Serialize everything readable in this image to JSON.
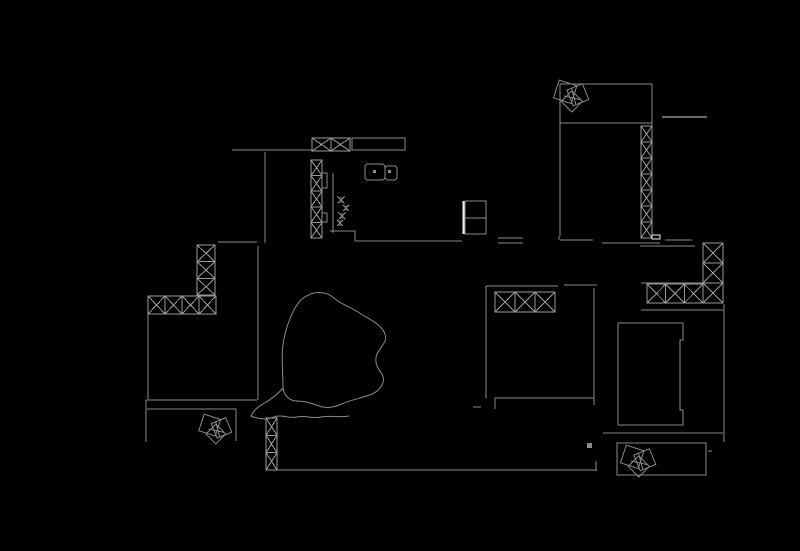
{
  "meta": {
    "app": "cad-floor-plan-view",
    "width": 800,
    "height": 551,
    "background": "#000000"
  },
  "palette": {
    "line": "#8a8a8a",
    "hatch": "#9a9a9a",
    "bright": "#eeeeee",
    "dim": "#6b6b6b",
    "fill": "#8c8c8c"
  },
  "drawing": {
    "walls": [
      {
        "name": "top-room-top-wall",
        "x1": 560,
        "y1": 84,
        "x2": 652,
        "y2": 84
      },
      {
        "name": "top-room-left-wall",
        "x1": 560,
        "y1": 84,
        "x2": 560,
        "y2": 236
      },
      {
        "name": "top-room-divider",
        "x1": 560,
        "y1": 123,
        "x2": 652,
        "y2": 123
      },
      {
        "name": "top-room-right-wall-upper",
        "x1": 652,
        "y1": 84,
        "x2": 652,
        "y2": 126
      },
      {
        "name": "balcony-rail-dash",
        "x1": 662,
        "y1": 117,
        "x2": 707,
        "y2": 117,
        "w": 2,
        "c": "dim"
      },
      {
        "name": "kitchen-top-wall",
        "x1": 232,
        "y1": 150,
        "x2": 312,
        "y2": 150
      },
      {
        "name": "corridor-wall-upper",
        "x1": 265,
        "y1": 152,
        "x2": 265,
        "y2": 243
      },
      {
        "name": "counter-inner-edge",
        "x1": 333,
        "y1": 173,
        "x2": 333,
        "y2": 233
      },
      {
        "name": "counter-return-top",
        "x1": 330,
        "y1": 231,
        "x2": 355,
        "y2": 231
      },
      {
        "name": "counter-return-side",
        "x1": 355,
        "y1": 231,
        "x2": 355,
        "y2": 241
      },
      {
        "name": "kitchen-bottom-wall",
        "x1": 355,
        "y1": 241,
        "x2": 462,
        "y2": 241
      },
      {
        "name": "hall-top-wall",
        "x1": 218,
        "y1": 242,
        "x2": 257,
        "y2": 242
      },
      {
        "name": "corridor-wall-lower",
        "x1": 258,
        "y1": 246,
        "x2": 258,
        "y2": 400
      },
      {
        "name": "left-outer-wall-upper",
        "x1": 148,
        "y1": 314,
        "x2": 148,
        "y2": 399
      },
      {
        "name": "left-outer-wall-lower",
        "x1": 146,
        "y1": 400,
        "x2": 146,
        "y2": 442
      },
      {
        "name": "entry-wall-outer",
        "x1": 146,
        "y1": 400,
        "x2": 257,
        "y2": 400
      },
      {
        "name": "entry-wall-inner",
        "x1": 147,
        "y1": 409,
        "x2": 236,
        "y2": 409
      },
      {
        "name": "entry-side-wall",
        "x1": 236,
        "y1": 409,
        "x2": 236,
        "y2": 441
      },
      {
        "name": "bottom-outer-wall",
        "x1": 277,
        "y1": 470,
        "x2": 597,
        "y2": 470
      },
      {
        "name": "bottom-wall-end-tick",
        "x1": 596,
        "y1": 461,
        "x2": 596,
        "y2": 471
      },
      {
        "name": "mid-wall-seg-a-top",
        "x1": 498,
        "y1": 238,
        "x2": 523,
        "y2": 238
      },
      {
        "name": "mid-wall-seg-a-bottom",
        "x1": 498,
        "y1": 243,
        "x2": 523,
        "y2": 243
      },
      {
        "name": "mid-wall-seg-b",
        "x1": 560,
        "y1": 240,
        "x2": 593,
        "y2": 240
      },
      {
        "name": "mid-wall-seg-c",
        "x1": 602,
        "y1": 243,
        "x2": 660,
        "y2": 243
      },
      {
        "name": "mid-wall-seg-d",
        "x1": 640,
        "y1": 246,
        "x2": 695,
        "y2": 246
      },
      {
        "name": "mid-wall-seg-e",
        "x1": 665,
        "y1": 240,
        "x2": 692,
        "y2": 240
      },
      {
        "name": "mid-wall-tick",
        "x1": 559,
        "y1": 236,
        "x2": 559,
        "y2": 240
      },
      {
        "name": "bedroom1-top-wall-left",
        "x1": 486,
        "y1": 286,
        "x2": 558,
        "y2": 286
      },
      {
        "name": "bedroom1-top-wall-right",
        "x1": 564,
        "y1": 285,
        "x2": 597,
        "y2": 285
      },
      {
        "name": "bedroom1-left-wall",
        "x1": 486,
        "y1": 286,
        "x2": 486,
        "y2": 398
      },
      {
        "name": "bedroom1-right-wall",
        "x1": 594,
        "y1": 288,
        "x2": 594,
        "y2": 405
      },
      {
        "name": "bedroom1-bottom-wall",
        "x1": 495,
        "y1": 398,
        "x2": 594,
        "y2": 398
      },
      {
        "name": "bedroom1-door-jamb",
        "x1": 495,
        "y1": 398,
        "x2": 495,
        "y2": 409
      },
      {
        "name": "bedroom1-door-leaf",
        "x1": 473,
        "y1": 407,
        "x2": 481,
        "y2": 407
      },
      {
        "name": "bedroom2-top-edge",
        "x1": 641,
        "y1": 283,
        "x2": 703,
        "y2": 283
      },
      {
        "name": "bedroom2-wall-under-hatch",
        "x1": 641,
        "y1": 310,
        "x2": 723,
        "y2": 310
      },
      {
        "name": "bedroom2-right-wall",
        "x1": 724,
        "y1": 304,
        "x2": 724,
        "y2": 442
      },
      {
        "name": "bedroom2-bottom-wall",
        "x1": 603,
        "y1": 433,
        "x2": 723,
        "y2": 433
      },
      {
        "name": "planter-tick",
        "x1": 708,
        "y1": 451,
        "x2": 712,
        "y2": 451
      },
      {
        "name": "fridge-divider",
        "x1": 465,
        "y1": 218,
        "x2": 486,
        "y2": 218
      },
      {
        "name": "fridge-door-edge",
        "x1": 464,
        "y1": 201,
        "x2": 464,
        "y2": 234,
        "w": 3,
        "c": "bright"
      }
    ],
    "hatched_walls": [
      {
        "name": "kitchen-window-top",
        "o": "h",
        "x": 312,
        "y": 138,
        "len": 38,
        "t": 13,
        "cells": 2
      },
      {
        "name": "kitchen-wall-column",
        "o": "v",
        "x": 311,
        "y": 160,
        "len": 78,
        "t": 11,
        "cells": 5
      },
      {
        "name": "top-room-wall-column",
        "o": "v",
        "x": 641,
        "y": 126,
        "len": 112,
        "t": 11,
        "cells": 7
      },
      {
        "name": "bedroom2-window-row",
        "o": "h",
        "x": 647,
        "y": 284,
        "len": 56,
        "t": 19,
        "cells": 3
      },
      {
        "name": "bedroom2-corner-column",
        "o": "v",
        "x": 703,
        "y": 243,
        "len": 60,
        "t": 20,
        "cells": 3
      },
      {
        "name": "bedroom1-window-row",
        "o": "h",
        "x": 495,
        "y": 292,
        "len": 60,
        "t": 20,
        "cells": 3
      },
      {
        "name": "left-wall-column",
        "o": "v",
        "x": 197,
        "y": 245,
        "len": 50,
        "t": 18,
        "cells": 3
      },
      {
        "name": "left-window-row",
        "o": "h",
        "x": 148,
        "y": 296,
        "len": 68,
        "t": 18,
        "cells": 4
      },
      {
        "name": "foyer-wall-column",
        "o": "v",
        "x": 266,
        "y": 418,
        "len": 52,
        "t": 11,
        "cells": 3
      }
    ],
    "rects": [
      {
        "name": "kitchen-countertop",
        "x": 352,
        "y": 138,
        "w": 53,
        "h": 12
      },
      {
        "name": "cabinet-strip-upper",
        "x": 322,
        "y": 173,
        "w": 5,
        "h": 15
      },
      {
        "name": "cabinet-strip-lower",
        "x": 322,
        "y": 213,
        "w": 5,
        "h": 9
      },
      {
        "name": "fridge",
        "x": 465,
        "y": 201,
        "w": 21,
        "h": 33
      },
      {
        "name": "sink-basin-large",
        "x": 365,
        "y": 164,
        "w": 20,
        "h": 16,
        "rx": 3
      },
      {
        "name": "sink-basin-small",
        "x": 385,
        "y": 166,
        "w": 12,
        "h": 14,
        "rx": 3
      },
      {
        "name": "sink-drain-left",
        "x": 373,
        "y": 170,
        "w": 3,
        "h": 3,
        "fill": "fill",
        "stroke": false
      },
      {
        "name": "sink-drain-right",
        "x": 388,
        "y": 170,
        "w": 3,
        "h": 3,
        "fill": "fill",
        "stroke": false
      },
      {
        "name": "planter-box",
        "x": 617,
        "y": 443,
        "w": 89,
        "h": 32
      },
      {
        "name": "small-bright-marker",
        "x": 652,
        "y": 235,
        "w": 8,
        "h": 4,
        "c": "bright"
      },
      {
        "name": "filled-square-marker",
        "x": 587,
        "y": 443,
        "w": 5,
        "h": 5,
        "fill": "fill",
        "stroke": false
      }
    ],
    "paths": [
      {
        "name": "wardrobe-bed",
        "d": "M 618 323 L 683 323 L 683 340 L 680 340 L 680 410 L 683 410 L 683 425 L 618 425 Z"
      },
      {
        "name": "tree-canopy",
        "d": "M 302 299 C 313 290 326 291 334 298 C 342 305 353 308 361 314 C 371 320 382 325 385 334 C 388 342 380 347 377 354 C 374 361 377 368 382 374 C 386 381 381 390 372 394 C 362 398 350 400 342 404 C 335 407 327 409 319 406 C 311 403 305 401 297 401 C 289 401 284 395 283 388 C 283 371 281 356 283 345 C 285 329 293 307 302 299 M 283 388 C 277 395 270 400 263 404 C 257 407 253 412 251 416 C 258 419 266 420 274 417 C 282 414 289 419 297 417 C 305 415 312 419 321 417 C 330 415 340 418 349 416",
        "w": 1
      }
    ],
    "plants": [
      {
        "name": "plant-top-room",
        "cx": 573,
        "cy": 96,
        "s": 30
      },
      {
        "name": "plant-foyer",
        "cx": 217,
        "cy": 429,
        "s": 28
      },
      {
        "name": "plant-planter",
        "cx": 640,
        "cy": 461,
        "s": 30
      }
    ],
    "glyph_crosses": [
      {
        "name": "stove-burner-mark",
        "x": 341,
        "y": 200,
        "s": 7
      },
      {
        "name": "stove-burner-mark",
        "x": 346,
        "y": 208,
        "s": 6
      },
      {
        "name": "stove-burner-mark",
        "x": 342,
        "y": 216,
        "s": 7
      },
      {
        "name": "stove-burner-mark",
        "x": 340,
        "y": 223,
        "s": 6
      }
    ]
  }
}
